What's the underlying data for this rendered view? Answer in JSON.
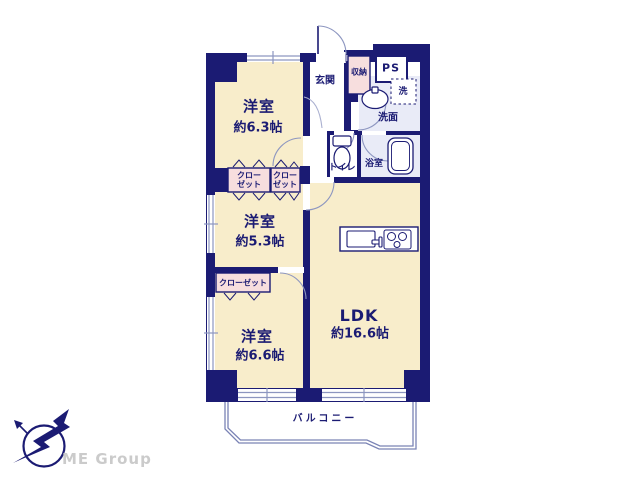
{
  "document": {
    "type": "floor-plan",
    "background": "#ffffff"
  },
  "colors": {
    "wall_navy": "#1b1b73",
    "room_cream": "#f8edcb",
    "closet_pink": "#f7dede",
    "wet_area_lavender": "#e9ebf7",
    "window_line": "#8d96c0",
    "balcony_line": "#7a83b5",
    "brand_gray": "#cbcbcb"
  },
  "floor_plan": {
    "rooms": [
      {
        "name": "洋室",
        "size": "約6.3帖"
      },
      {
        "name": "洋室",
        "size": "約5.3帖"
      },
      {
        "name": "洋室",
        "size": "約6.6帖"
      },
      {
        "name": "LDK",
        "size": "約16.6帖"
      }
    ],
    "labels": {
      "entrance": "玄関",
      "storage": "収納",
      "pipe_space": "PS",
      "laundry": "洗",
      "washroom": "洗面",
      "toilet": "トイレ",
      "bathroom": "浴室",
      "closet_line1": "クロー",
      "closet_line2": "ゼット",
      "closet_full": "クローゼット",
      "balcony": "バルコニー"
    },
    "icons": [
      "toilet-fixture-icon",
      "washbasin-icon",
      "bathtub-icon",
      "kitchen-sink-icon",
      "stove-burners-icon",
      "door-swing-arc-icon",
      "folding-door-chevron-icon",
      "window-double-line-icon"
    ]
  },
  "branding": {
    "company_name": "ME Group",
    "logo": "bird-compass-logo"
  }
}
